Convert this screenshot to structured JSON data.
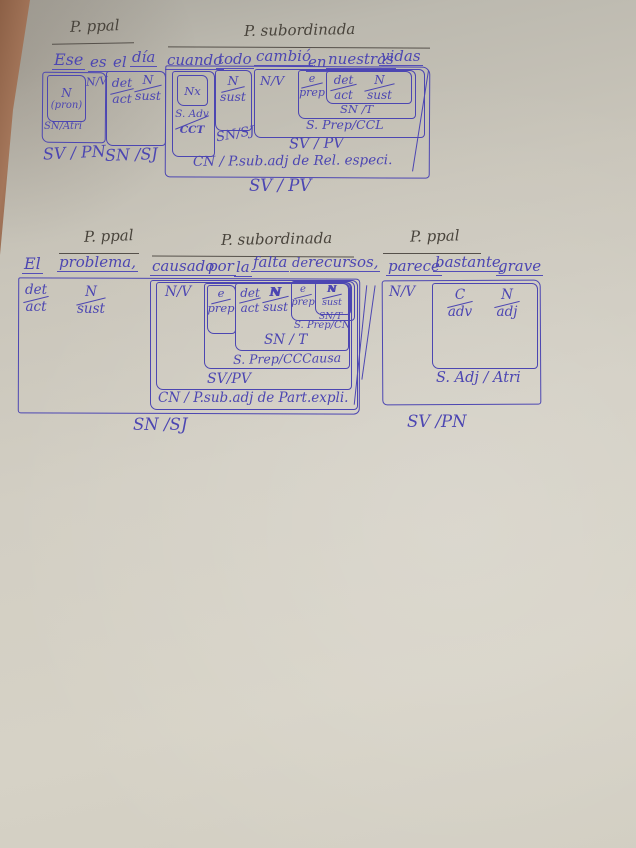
{
  "photo": {
    "ink_color": "#4c46b2",
    "pencil_color": "#49443c",
    "paper_color": "#d2cec3",
    "wood_color": "#91664a"
  },
  "s1": {
    "header_main": "P. ppal",
    "header_sub": "P. subordinada",
    "words": [
      "Ese",
      "es",
      "el",
      "día",
      "cuando",
      "todo",
      "cambió",
      "en",
      "nuestras",
      "vidas"
    ],
    "ese": {
      "cat": "N",
      "sub": "(pron)",
      "fn": "SN/Atri"
    },
    "es_nv": "N/V",
    "svpn": "SV / PN",
    "el": {
      "top": "det",
      "bot": "act"
    },
    "dia": {
      "top": "N",
      "bot": "sust"
    },
    "snsj_left": "SN /SJ",
    "cuando": {
      "nx": "Nx",
      "top": "S. Adv",
      "bot": "CCT"
    },
    "todo": {
      "top": "N",
      "bot": "sust",
      "fn": "SN/SJ"
    },
    "cambio_nv": "N/V",
    "en": {
      "top": "e",
      "bot": "prep"
    },
    "nuestras": {
      "top": "det",
      "bot": "act"
    },
    "vidas": {
      "top": "N",
      "bot": "sust"
    },
    "snt": "SN /T",
    "sprep_ccl": "S. Prep/CCL",
    "svpv_inner": "SV / PV",
    "cn": "CN / P.sub.adj de Rel. especi.",
    "svpv_outer": "SV / PV"
  },
  "s2": {
    "header_main1": "P. ppal",
    "header_sub": "P. subordinada",
    "header_main2": "P. ppal",
    "words": [
      "El",
      "problema,",
      "causado",
      "por",
      "la",
      "falta",
      "de",
      "recursos,",
      "parece",
      "bastante",
      "grave"
    ],
    "el": {
      "top": "det",
      "bot": "act"
    },
    "problema": {
      "top": "N",
      "bot": "sust"
    },
    "causado_nv": "N/V",
    "por": {
      "top": "e",
      "bot": "prep"
    },
    "la": {
      "top": "det",
      "bot": "act"
    },
    "falta": {
      "top": "N",
      "bot": "sust"
    },
    "de": {
      "top": "e",
      "bot": "prep"
    },
    "recursos": {
      "top": "N",
      "bot": "sust",
      "fn": "SN/T"
    },
    "sprep_cn": "S. Prep/CN",
    "snt_big": "SN / T",
    "sprep_cccausa": "S. Prep/CCCausa",
    "svpv": "SV/PV",
    "cn": "CN / P.sub.adj de Part.expli.",
    "snsj": "SN /SJ",
    "parece_nv": "N/V",
    "bastante": {
      "top": "C",
      "bot": "adv"
    },
    "grave": {
      "top": "N",
      "bot": "adj"
    },
    "sadj_atri": "S. Adj / Atri",
    "svpn": "SV /PN"
  }
}
